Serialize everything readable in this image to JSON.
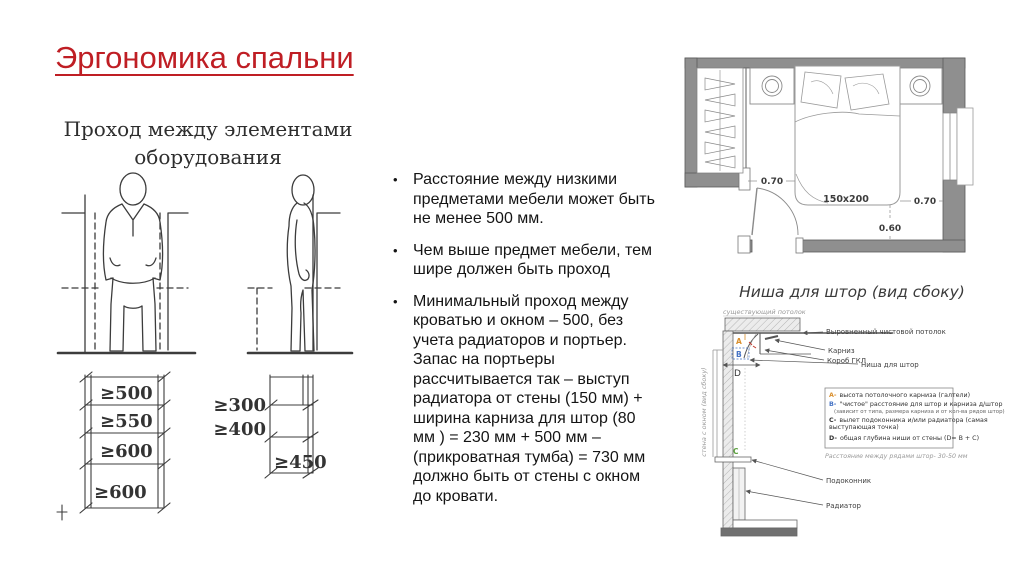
{
  "slide": {
    "title": "Эргономика спальни",
    "title_color": "#BF1E24",
    "bullet_char": "•"
  },
  "passage_diagram": {
    "title_line1": "Проход между элементами",
    "title_line2": "оборудования",
    "left_dims": [
      "≥500",
      "≥550",
      "≥600",
      "≥600"
    ],
    "right_dims": [
      "≥300",
      "≥400",
      "≥450"
    ]
  },
  "bullets": [
    "Расстояние между низкими предметами мебели может быть не менее 500 мм.",
    "Чем выше предмет мебели, тем шире должен быть проход",
    "Минимальный проход между кроватью и окном – 500, без учета радиаторов и портьер. Запас на портьеры рассчитывается так – выступ радиатора от стены (150 мм) + ширина карниза для штор (80 мм ) = 230 мм + 500 мм – (прикроватная тумба) = 730 мм должно быть от стены с окном до кровати."
  ],
  "floor_plan": {
    "bed_label": "150x200",
    "dim_left": "0.70",
    "dim_right": "0.70",
    "dim_bottom": "0.60"
  },
  "curtain_niche": {
    "title": "Ниша для штор (вид сбоку)",
    "ceiling_label": "существующий потолок",
    "wall_label": "стена с окном (вид сбоку)",
    "callout_finish_ceiling": "Выровненный чистовой потолок",
    "callout_cornice": "Карниз",
    "callout_box": "Короб ГКЛ",
    "callout_niche": "Ниша для штор",
    "callout_sill": "Подоконник",
    "callout_radiator": "Радиатор",
    "letters": {
      "a": "A",
      "b": "B",
      "c": "C",
      "d": "D"
    },
    "legend": [
      {
        "letter": "A-",
        "color": "#d98e2b",
        "line1": "высота потолочного карниза (галтели)",
        "line2": ""
      },
      {
        "letter": "B-",
        "color": "#4472c4",
        "line1": "\"чистое\" расстояние для штор и карниза д/штор",
        "line2": "(зависит от типа, размера карниза и от кол-ва рядов штор)"
      },
      {
        "letter": "C-",
        "color": "#333333",
        "line1": "вылет подоконника и/или радиатора (самая",
        "line2": "выступающая точка)"
      },
      {
        "letter": "D-",
        "color": "#333333",
        "line1": "общая глубина ниши от стены (D= B + C)",
        "line2": ""
      }
    ],
    "note": "Расстояние между рядами штор- 30-50 мм"
  }
}
